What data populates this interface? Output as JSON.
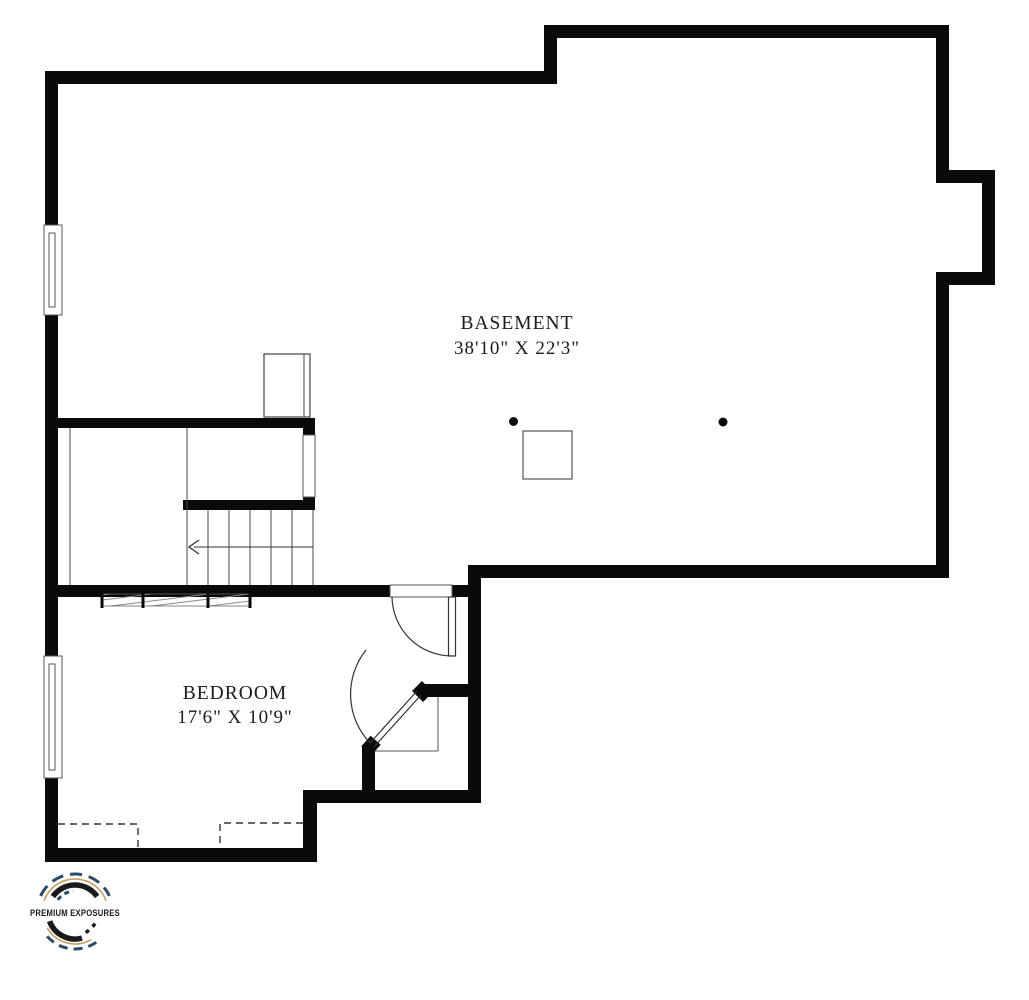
{
  "page": {
    "background": "#ffffff"
  },
  "plan": {
    "type": "basement-floor-plan",
    "wall_color": "#0a0a0a",
    "thin_line_color": "#4a4a4a",
    "rooms": [
      {
        "id": "basement",
        "label": "BASEMENT",
        "dimensions": "38'10\" X 22'3\""
      },
      {
        "id": "bedroom",
        "label": "BEDROOM",
        "dimensions": "17'6\" X 10'9\""
      }
    ],
    "features": {
      "windows": 2,
      "doors": 2,
      "support_columns": 2,
      "stair_treads": 6,
      "stair_arrow_direction": "left"
    }
  },
  "logo": {
    "text": "PREMIUM EXPOSURES",
    "colors": {
      "navy": "#2c4a63",
      "gold": "#c49a5e",
      "ink": "#1a1a1a"
    }
  }
}
